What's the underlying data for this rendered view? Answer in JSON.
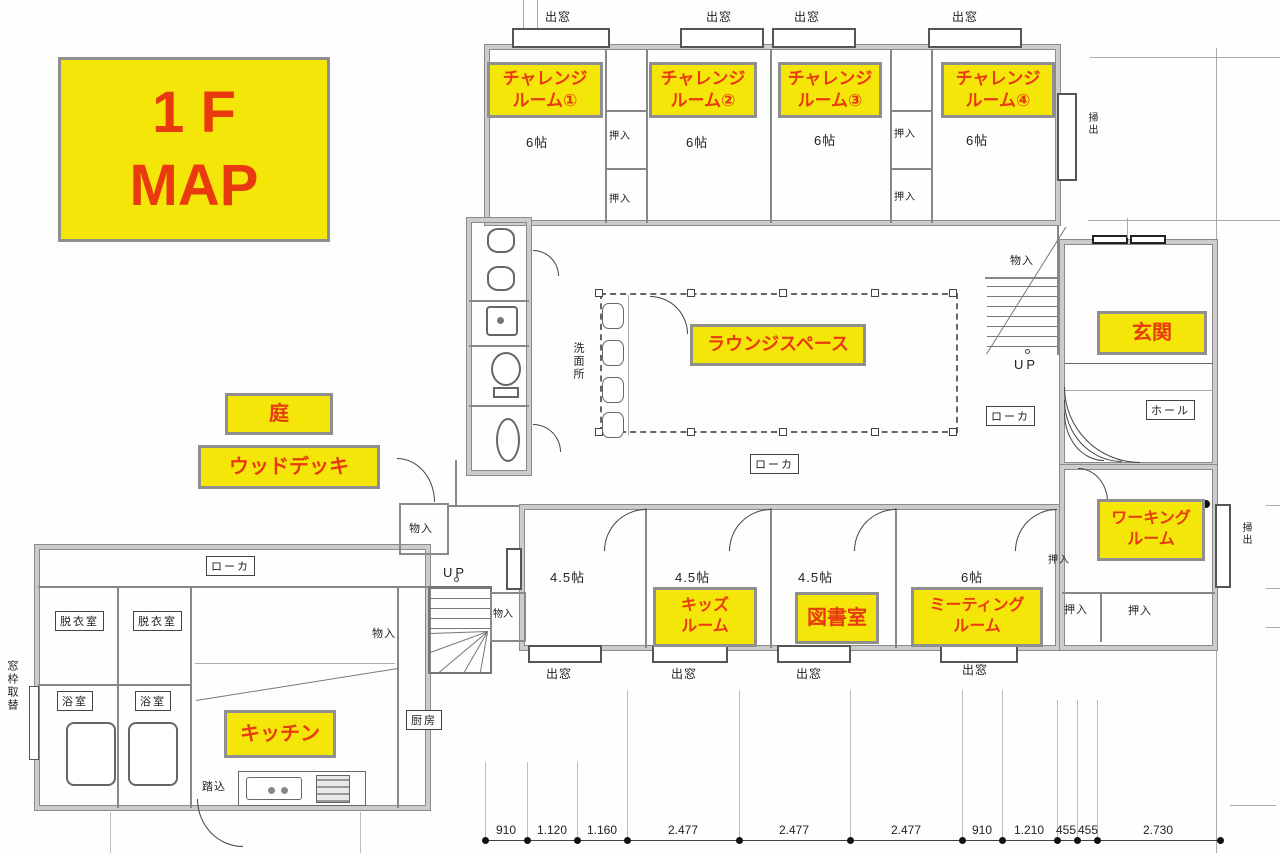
{
  "title": {
    "line1": "1 F",
    "line2": "MAP"
  },
  "colors": {
    "label_bg": "#f5e60a",
    "label_border": "#8f8f8f",
    "label_text": "#e83a0e",
    "wall_fill": "#cccccc",
    "wall_edge": "#8a8a8a",
    "line": "#555555",
    "background": "#fefefe"
  },
  "labels": {
    "challenge1_line1": "チャレンジ",
    "challenge1_line2": "ルーム①",
    "challenge2_line1": "チャレンジ",
    "challenge2_line2": "ルーム②",
    "challenge3_line1": "チャレンジ",
    "challenge3_line2": "ルーム③",
    "challenge4_line1": "チャレンジ",
    "challenge4_line2": "ルーム④",
    "lounge": "ラウンジスペース",
    "entrance": "玄関",
    "working_line1": "ワーキング",
    "working_line2": "ルーム",
    "garden": "庭",
    "wood_deck": "ウッドデッキ",
    "kids_line1": "キッズ",
    "kids_line2": "ルーム",
    "library": "図書室",
    "meeting_line1": "ミーティング",
    "meeting_line2": "ルーム",
    "kitchen": "キッチン"
  },
  "room_texts": {
    "bay_window": "出窓",
    "closet": "押入",
    "storage": "物入",
    "corridor": "ローカ",
    "hall": "ホール",
    "washroom": "洗面所",
    "dressing_room": "脱衣室",
    "bathroom": "浴室",
    "galley": "厨房",
    "entry_step": "踏込",
    "sweep_window": "掃出",
    "window_frame_note": "窓枠取替",
    "up": "UP",
    "six_mats": "6帖",
    "four_half_mats": "4.5帖"
  },
  "dimensions": [
    "910",
    "1.120",
    "1.160",
    "2.477",
    "2.477",
    "2.477",
    "910",
    "1.210",
    "455",
    "455",
    "2.730"
  ]
}
